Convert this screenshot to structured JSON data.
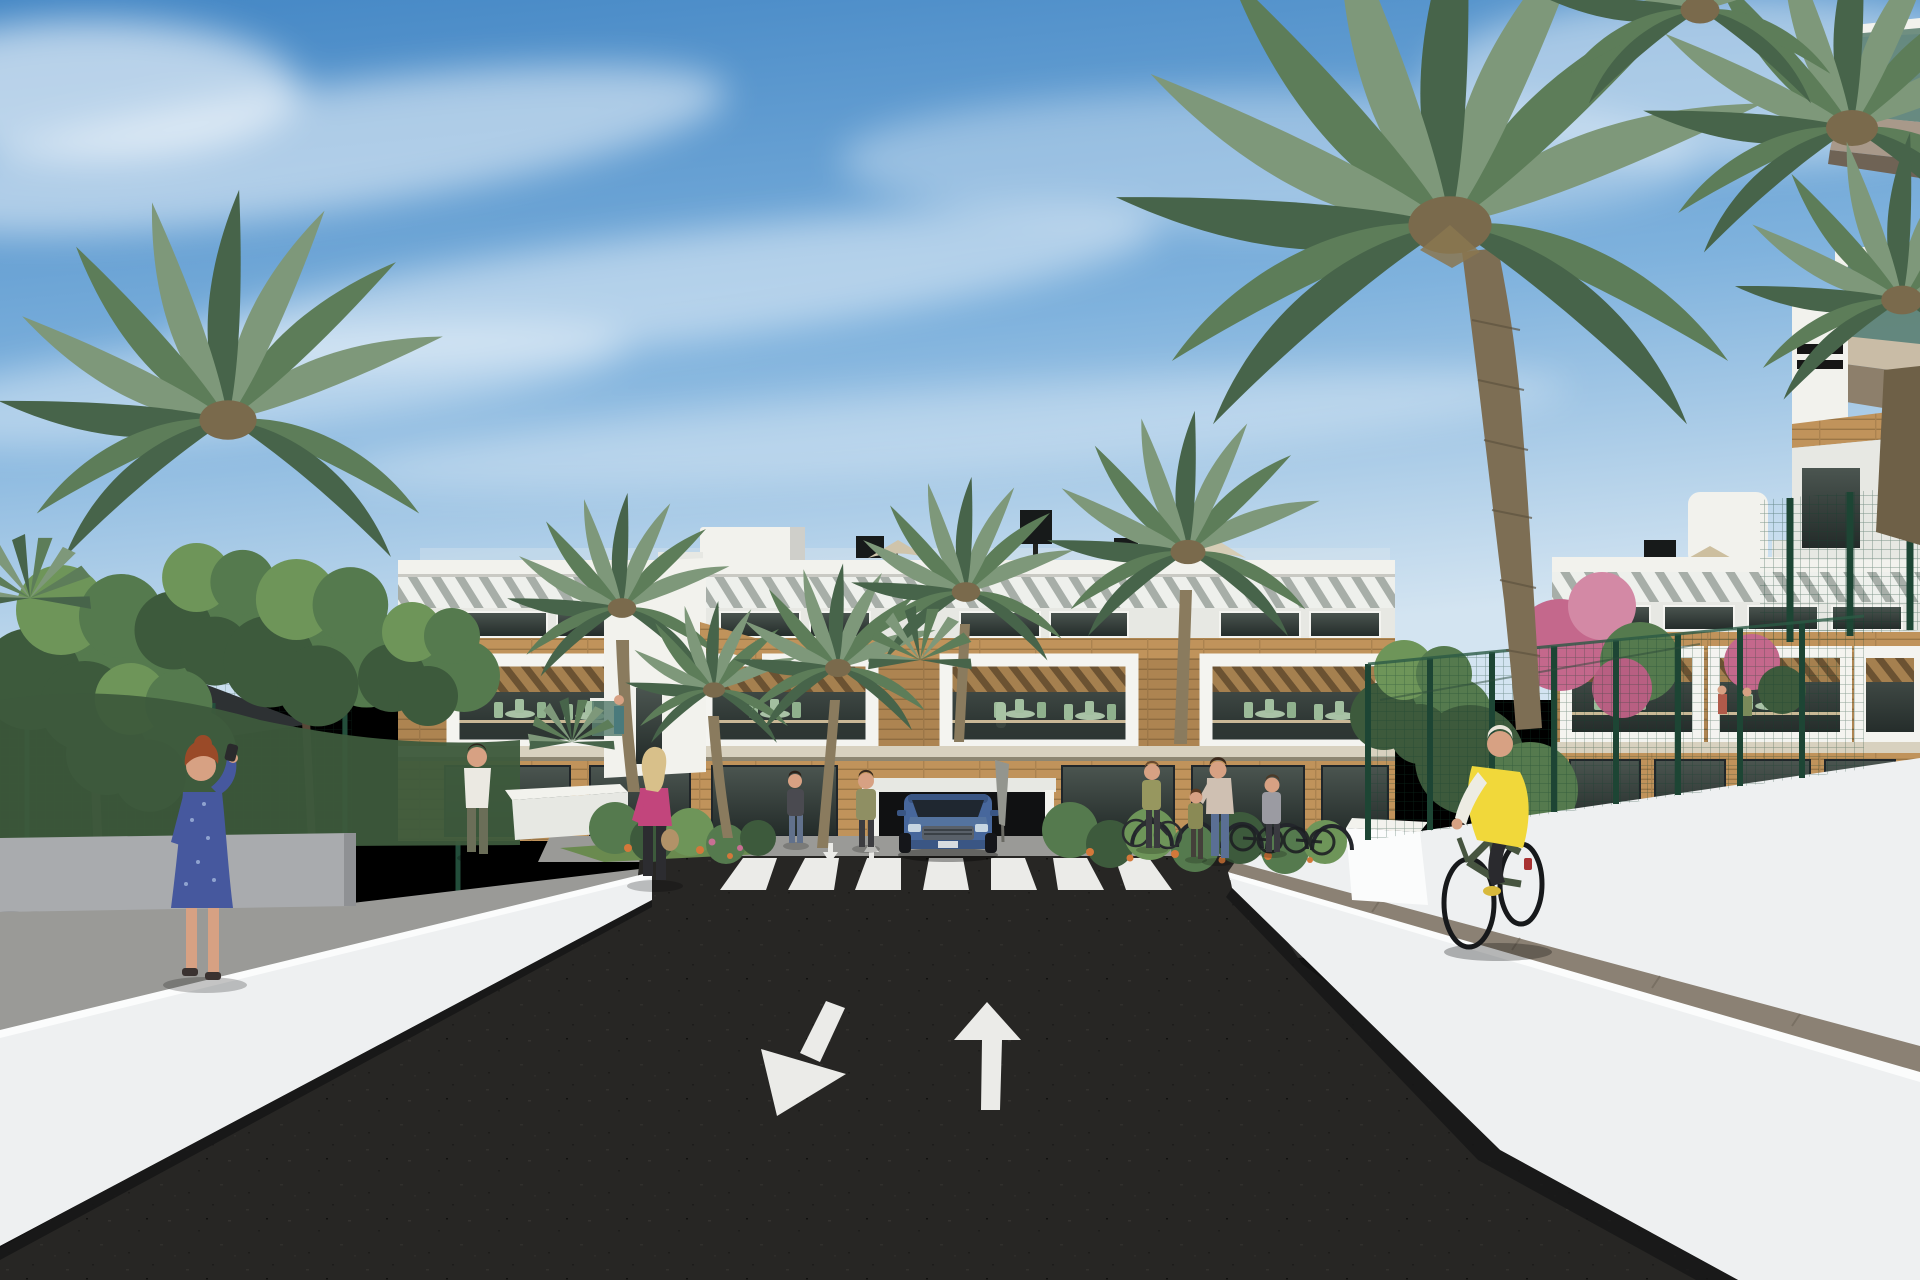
{
  "meta": {
    "description": "Photorealistic 3D architectural rendering of a modern white three-storey apartment complex with rooftop terraces, wooden pergola balconies and wood cladding, seen from an entrance road with a pedestrian crosswalk, lane arrows, a blue SUV leaving an underground garage, palm trees, a padel court with black shade sail, pedestrians and a cyclist under a clear blue sky",
    "type": "architectural-render",
    "time_of_day": "sunny daytime"
  },
  "palette": {
    "sky_top": "#4487c5",
    "sky_mid": "#7fb2dd",
    "sky_horizon": "#d3e4f1",
    "cloud": "#ffffff",
    "white_lit": "#f2f2ed",
    "white_dim": "#e7e8e3",
    "white_shade": "#cfcfca",
    "wood": "#c09159",
    "glass_dark": "#2e3734",
    "slab": "#d8d1bf",
    "slab_under": "#8d8672",
    "asphalt": "#272624",
    "paving": "#9a9a97",
    "paver_path": "#8b8174",
    "wall_lit": "#eef0f1",
    "wall_stripe": "#fbfcfc",
    "wall_shade": "#a9abae",
    "wall_base": "#161616",
    "marking_white": "#ebebe8",
    "green_dark": "#3d5a3c",
    "green_mid": "#557a4e",
    "green_light": "#6e9559",
    "frond_light": "#7e987a",
    "frond_mid": "#5d7d59",
    "frond_dark": "#47644a",
    "trunk": "#8a7b5e",
    "fence_green": "#1f4a38",
    "skin": "#d7a183",
    "sail": "#2d3133",
    "car_blue": "#47679c",
    "car_blue_dark": "#3a5684",
    "vest_yellow": "#f1d83a",
    "dress_blue": "#46589e",
    "pink_top": "#c2457c",
    "flower_orange": "#d4783a",
    "flower_pink": "#c86f93",
    "balcony_glass": "#5d8172"
  },
  "scene": {
    "sky": {
      "condition": "clear blue with wispy cirrus clouds"
    },
    "buildings": {
      "main_block": "white apartment block: rooftop terraces with parasols, diagonal louvre band, dark windows, wood cladding, four white-framed pergola terraces, ground-floor glazing and underground garage",
      "right_block": "matching apartment wing behind dark-green court fencing with pink bougainvillea",
      "foreground_corner": "near corner of a building with two green-glass balconies and taupe slabs"
    },
    "road": {
      "surface": "dark asphalt entrance road",
      "markings": [
        "zebra crosswalk",
        "up arrow (outgoing lane)",
        "down-left arrow (incoming lane)",
        "two small arrows at crosswalk"
      ],
      "kerbs": "white concrete retaining walls with bright top stripe"
    },
    "vehicles": [
      {
        "name": "blue SUV",
        "location": "emerging from garage ramp behind crosswalk"
      }
    ],
    "people": [
      {
        "name": "woman photographing",
        "detail": "red hair, blue patterned dress, raising phone",
        "location": "left sidewalk"
      },
      {
        "name": "man walking away",
        "detail": "white t-shirt, olive trousers",
        "location": "path by court gate"
      },
      {
        "name": "woman walking",
        "detail": "blonde, magenta top, black trousers, tan handbag",
        "location": "centre-left pavement"
      },
      {
        "name": "two women chatting",
        "detail": "standing either side of the garage ramp",
        "location": "centre"
      },
      {
        "name": "woman pushing bicycle",
        "location": "near bike racks"
      },
      {
        "name": "mother holding child's hand",
        "location": "near bike racks"
      },
      {
        "name": "woman in grey",
        "location": "beside bike racks"
      },
      {
        "name": "cyclist",
        "detail": "yellow gilet, white sleeves, dark green bike",
        "location": "right-hand ramp path"
      }
    ],
    "vegetation": {
      "palms": "phoenix date palms, one giant specimen right of centre",
      "trees": "broadleaf green trees on the left",
      "flowers": [
        "orange blooms in planting beds",
        "pink bougainvillea on right fence"
      ]
    },
    "court": {
      "fence": "dark green mesh sports-court fence",
      "sail": "black shade sail",
      "gate": "dark green access gate"
    }
  },
  "counts": {
    "crosswalk_stripes": 7,
    "large_road_arrows": 2,
    "small_road_arrows": 2,
    "pedestrians": 8,
    "cyclists": 1,
    "bike_racks": 5,
    "palm_trees": 12,
    "roof_parasols": 3
  }
}
